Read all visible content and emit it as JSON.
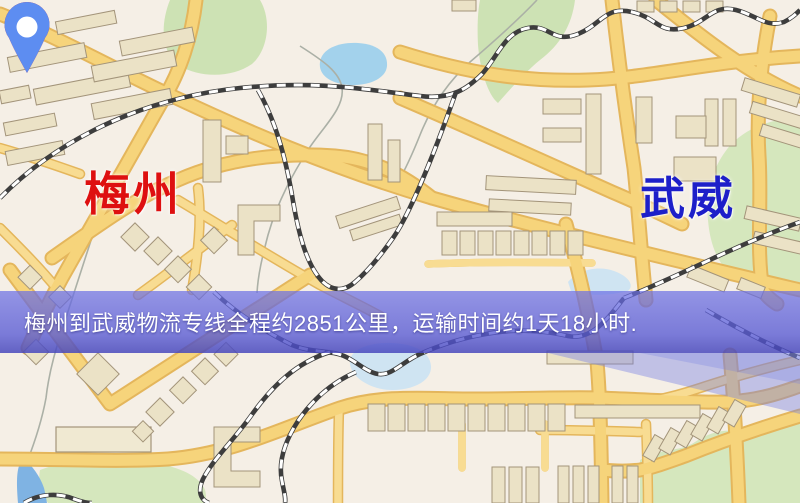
{
  "map": {
    "origin": {
      "name": "梅州",
      "label_color": "#de1010",
      "marker_color": "#e8130a"
    },
    "destination": {
      "name": "武威",
      "label_color": "#1d1fc9",
      "marker_color": "#5d8df1"
    },
    "banner": {
      "text": "梅州到武威物流专线全程约2851公里，运输时间约1天18小时.",
      "text_color": "#ffffff",
      "overlay_color": "#5a5ed2"
    },
    "route": {
      "distance_km": 2851,
      "transit_time": "1天18小时"
    },
    "palette": {
      "background": "#f5efe6",
      "road_fill": "#f6d47b",
      "road_casing": "#e4b65c",
      "building": "#ebe2c6",
      "park": "#d5e7bd",
      "water": "#a3d2ec",
      "railway": "#3d3d3d"
    }
  }
}
